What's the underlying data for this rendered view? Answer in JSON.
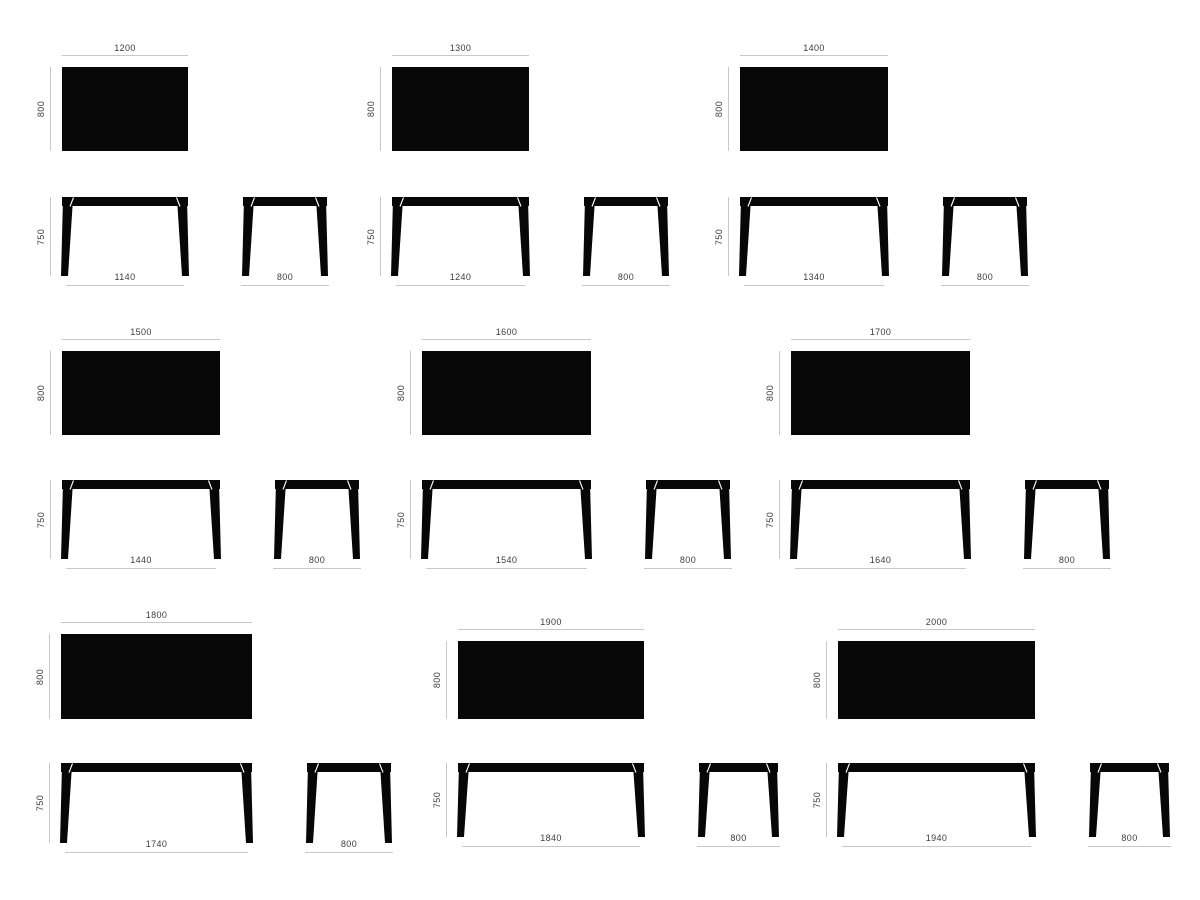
{
  "style": {
    "background": "#ffffff",
    "table_fill": "#070707",
    "dim_line_color": "#c8c8c8",
    "dim_text_color": "#3c3c3c",
    "notch_color": "#ffffff"
  },
  "diagram": {
    "description": "Nine table size variants, each with top view (width x depth), front elevation (height, floor width) and side elevation (depth)"
  },
  "variants": [
    {
      "name": "table-1200",
      "top": {
        "width_label": "1200",
        "depth_label": "800"
      },
      "front": {
        "height_label": "750",
        "floor_label": "1140"
      },
      "side": {
        "width_label": "800"
      },
      "layout": {
        "x": 62,
        "rect_y": 67,
        "front_y": 197,
        "rect_w": 126,
        "rect_h": 84,
        "front_h": 79,
        "side_w": 84,
        "gap": 55
      }
    },
    {
      "name": "table-1300",
      "top": {
        "width_label": "1300",
        "depth_label": "800"
      },
      "front": {
        "height_label": "750",
        "floor_label": "1240"
      },
      "side": {
        "width_label": "800"
      },
      "layout": {
        "x": 392,
        "rect_y": 67,
        "front_y": 197,
        "rect_w": 137,
        "rect_h": 84,
        "front_h": 79,
        "side_w": 84,
        "gap": 55
      }
    },
    {
      "name": "table-1400",
      "top": {
        "width_label": "1400",
        "depth_label": "800"
      },
      "front": {
        "height_label": "750",
        "floor_label": "1340"
      },
      "side": {
        "width_label": "800"
      },
      "layout": {
        "x": 740,
        "rect_y": 67,
        "front_y": 197,
        "rect_w": 148,
        "rect_h": 84,
        "front_h": 79,
        "side_w": 84,
        "gap": 55
      }
    },
    {
      "name": "table-1500",
      "top": {
        "width_label": "1500",
        "depth_label": "800"
      },
      "front": {
        "height_label": "750",
        "floor_label": "1440"
      },
      "side": {
        "width_label": "800"
      },
      "layout": {
        "x": 62,
        "rect_y": 351,
        "front_y": 480,
        "rect_w": 158,
        "rect_h": 84,
        "front_h": 79,
        "side_w": 84,
        "gap": 55
      }
    },
    {
      "name": "table-1600",
      "top": {
        "width_label": "1600",
        "depth_label": "800"
      },
      "front": {
        "height_label": "750",
        "floor_label": "1540"
      },
      "side": {
        "width_label": "800"
      },
      "layout": {
        "x": 422,
        "rect_y": 351,
        "front_y": 480,
        "rect_w": 169,
        "rect_h": 84,
        "front_h": 79,
        "side_w": 84,
        "gap": 55
      }
    },
    {
      "name": "table-1700",
      "top": {
        "width_label": "1700",
        "depth_label": "800"
      },
      "front": {
        "height_label": "750",
        "floor_label": "1640"
      },
      "side": {
        "width_label": "800"
      },
      "layout": {
        "x": 791,
        "rect_y": 351,
        "front_y": 480,
        "rect_w": 179,
        "rect_h": 84,
        "front_h": 79,
        "side_w": 84,
        "gap": 55
      }
    },
    {
      "name": "table-1800",
      "top": {
        "width_label": "1800",
        "depth_label": "800"
      },
      "front": {
        "height_label": "750",
        "floor_label": "1740"
      },
      "side": {
        "width_label": "800"
      },
      "layout": {
        "x": 61,
        "rect_y": 634,
        "front_y": 763,
        "rect_w": 191,
        "rect_h": 85,
        "front_h": 80,
        "side_w": 84,
        "gap": 55
      }
    },
    {
      "name": "table-1900",
      "top": {
        "width_label": "1900",
        "depth_label": "800"
      },
      "front": {
        "height_label": "750",
        "floor_label": "1840"
      },
      "side": {
        "width_label": "800"
      },
      "layout": {
        "x": 458,
        "rect_y": 641,
        "front_y": 763,
        "rect_w": 186,
        "rect_h": 78,
        "front_h": 74,
        "side_w": 79,
        "gap": 55
      }
    },
    {
      "name": "table-2000",
      "top": {
        "width_label": "2000",
        "depth_label": "800"
      },
      "front": {
        "height_label": "750",
        "floor_label": "1940"
      },
      "side": {
        "width_label": "800"
      },
      "layout": {
        "x": 838,
        "rect_y": 641,
        "front_y": 763,
        "rect_w": 197,
        "rect_h": 78,
        "front_h": 74,
        "side_w": 79,
        "gap": 55
      }
    }
  ]
}
